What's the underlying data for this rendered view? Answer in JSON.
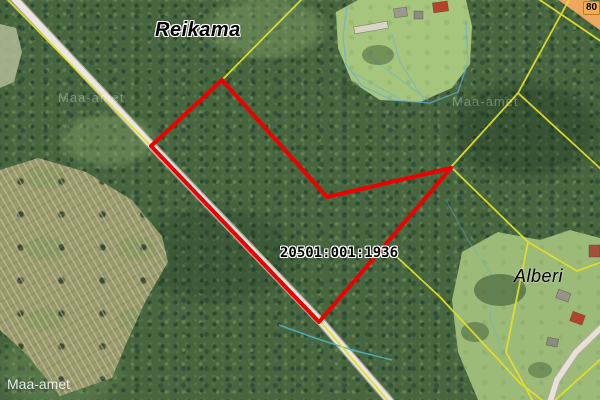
{
  "map": {
    "labels": {
      "place_top": "Reikama",
      "place_bottom_right": "Alberi",
      "cadastral_number": "20501:001:1936",
      "road_number": "80",
      "attribution": "Maa-amet",
      "watermark_left": "Maa-amet",
      "watermark_right": "Maa-amet"
    },
    "colors": {
      "parcel_outline": "#ee0000",
      "cadastral_line": "#e2de2a",
      "water_line": "#6aaed6",
      "stream_line": "#4db3c0",
      "road_fill": "#eae7df",
      "road_casing": "#a8a497",
      "highway_fill": "#eda75e"
    }
  }
}
